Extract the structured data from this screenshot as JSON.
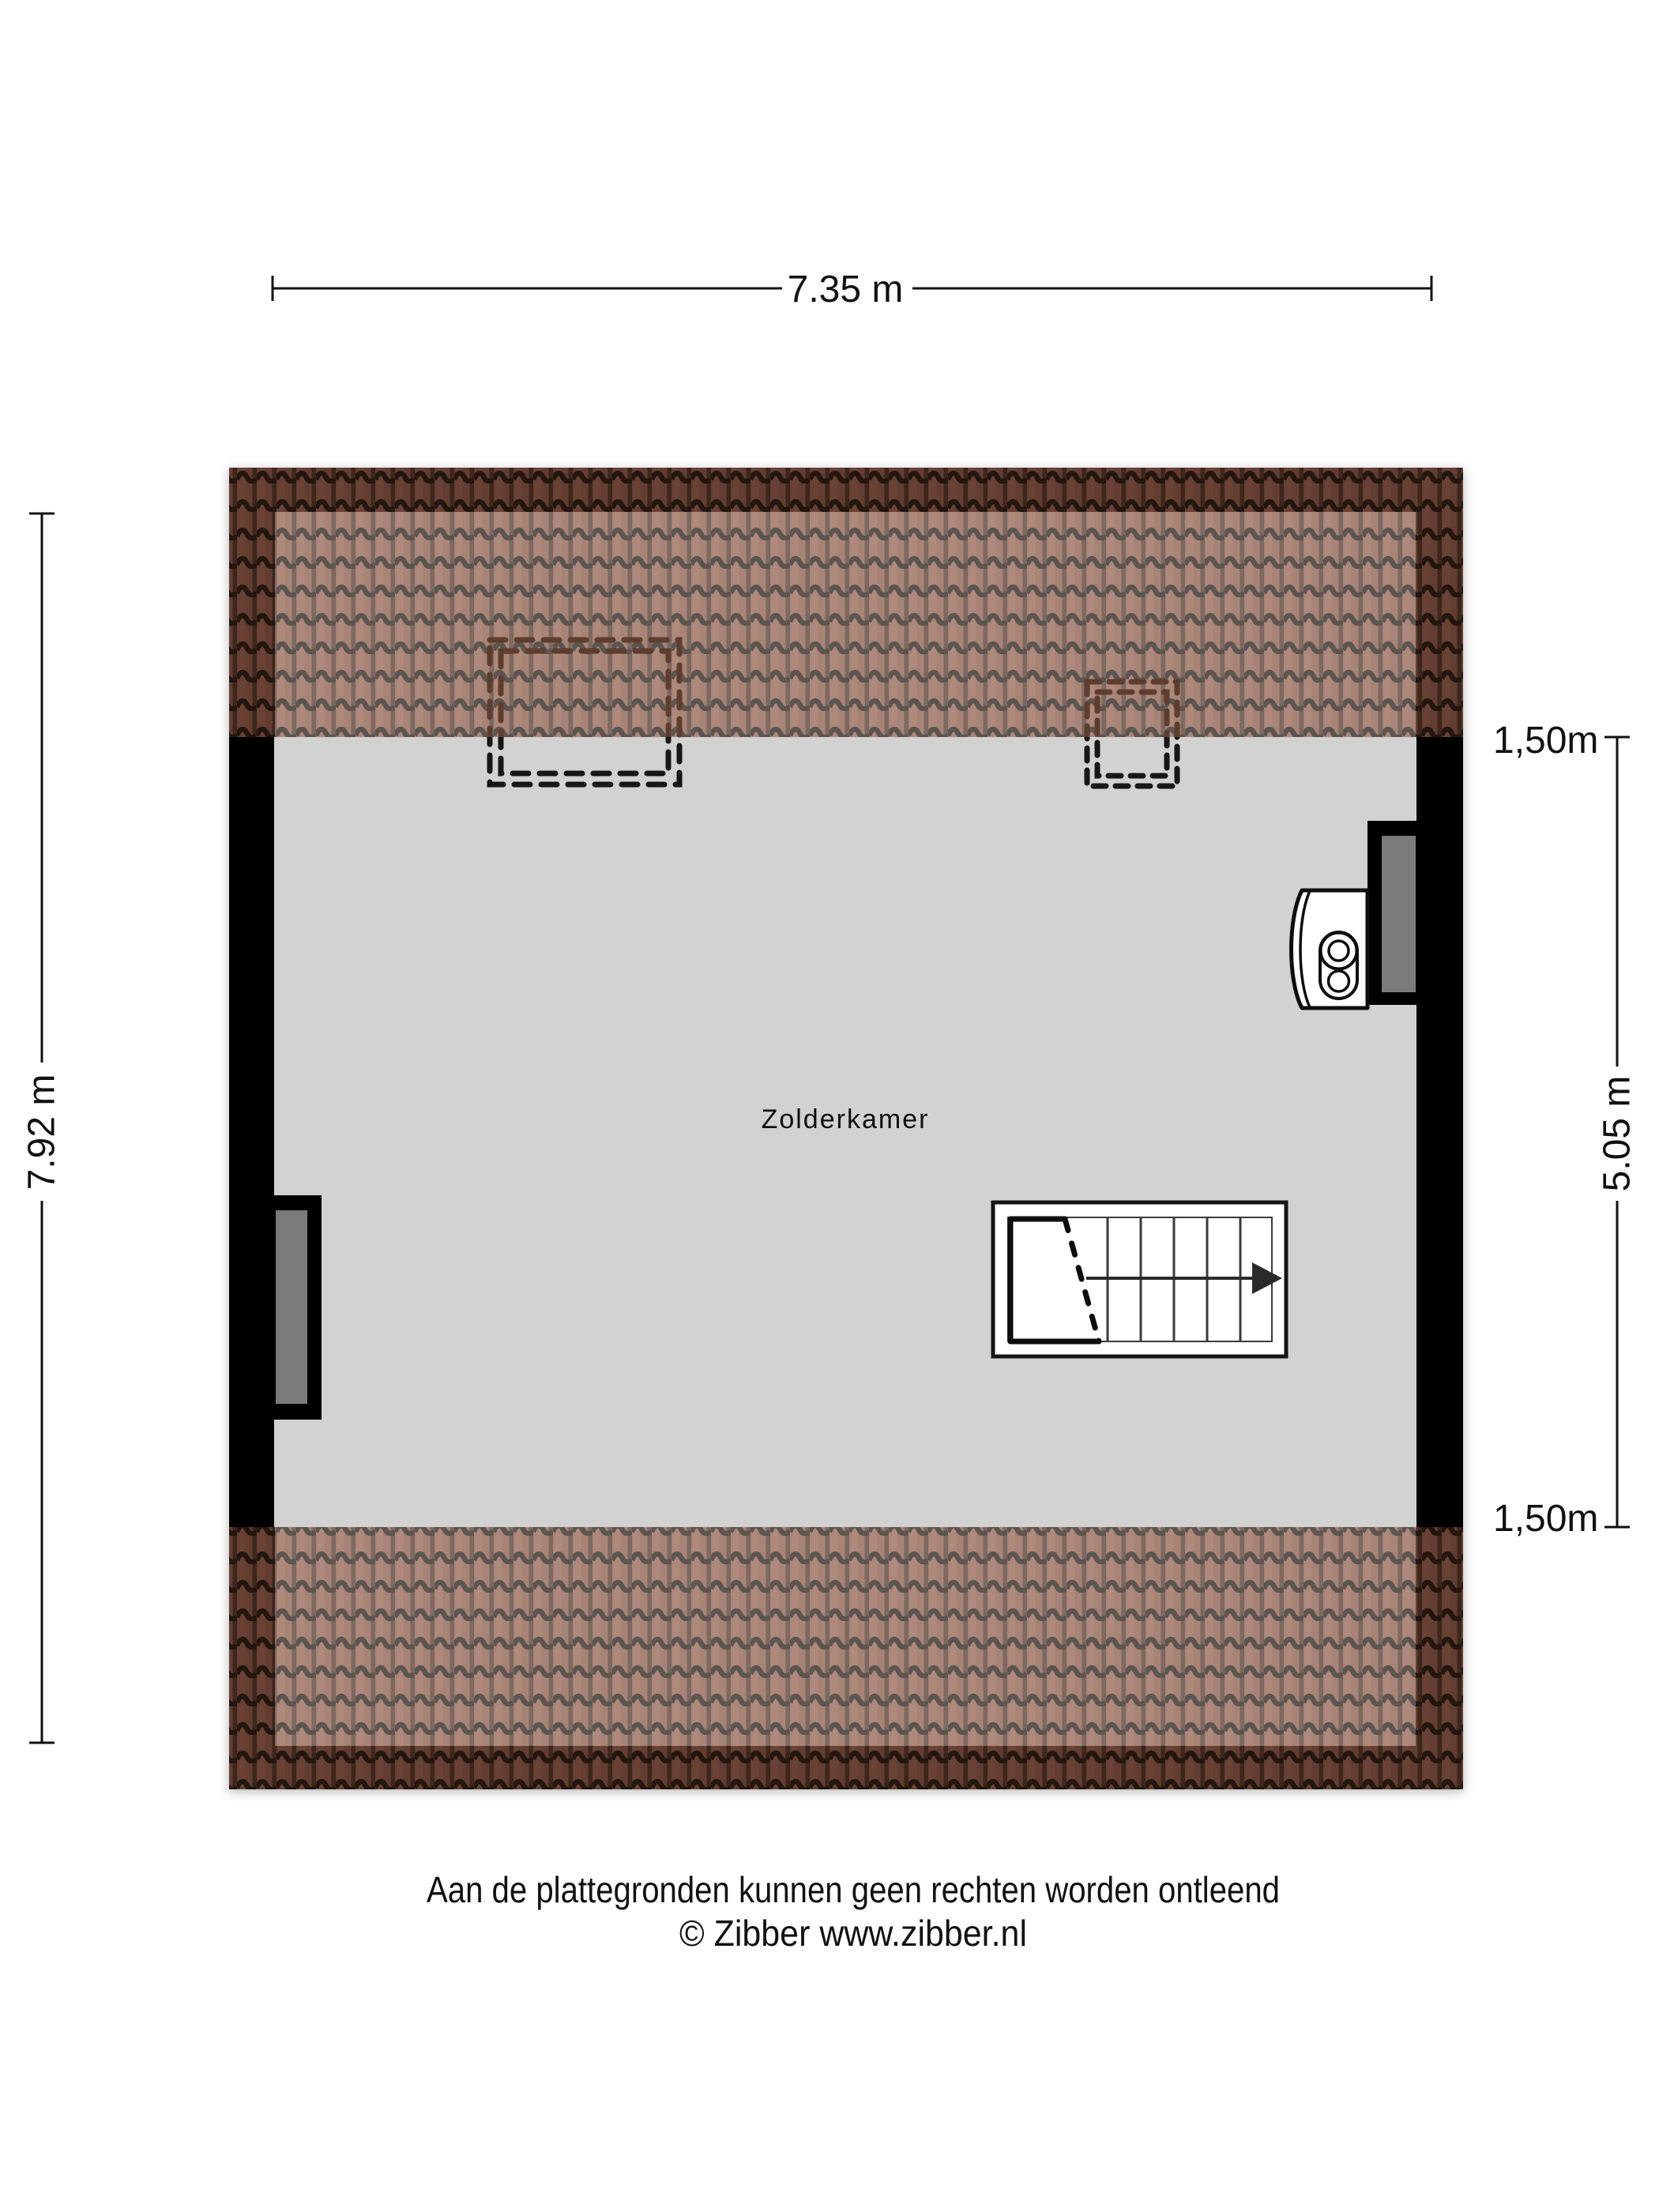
{
  "floorplan": {
    "room": {
      "label": "Zolderkamer"
    },
    "dimensions": {
      "top_width": "7.35 m",
      "left_height": "7.92 m",
      "right_top": "1,50m",
      "right_middle": "5.05 m",
      "right_bottom": "1,50m"
    },
    "footer": {
      "disclaimer": "Aan de plattegronden kunnen geen rechten worden ontleend",
      "copyright": "© Zibber www.zibber.nl"
    },
    "colors": {
      "background": "#ffffff",
      "floor": "#d2d2d2",
      "wall": "#000000",
      "window_pane": "#7a7a7a",
      "roof_tile_base": "#8a5a48",
      "roof_dark_band": "#684133",
      "roof_light_band": "#a78376",
      "dash_on_roof": "#5c3c2e",
      "dash_on_floor": "#121212"
    }
  }
}
